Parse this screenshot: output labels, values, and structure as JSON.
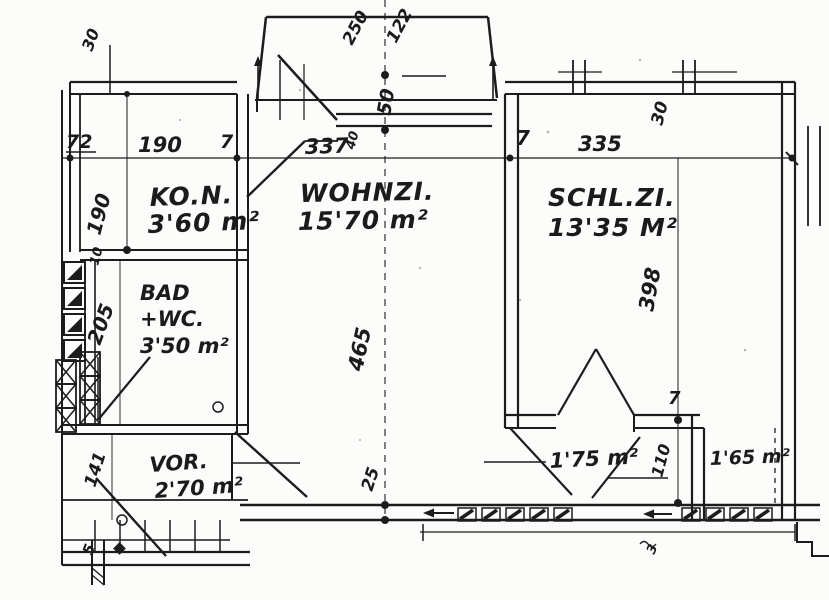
{
  "document": {
    "type": "architectural floor plan",
    "medium": "scanned hand-drawn blueprint",
    "ink_color": "#1c1c1c",
    "paper_color": "#fcfcfa"
  },
  "rooms": {
    "kitchen": {
      "label": "KO.N.",
      "area": "3'60 m²"
    },
    "living": {
      "label": "WOHNZI.",
      "area": "15'70 m²"
    },
    "bedroom": {
      "label": "SCHL.ZI.",
      "area": "13'35 M²"
    },
    "bath": {
      "label_line1": "BAD",
      "label_line2": "+WC.",
      "area": "3'50 m²"
    },
    "hall": {
      "label": "VOR.",
      "area": "2'70 m²"
    },
    "loggia_left": {
      "area": "1'75 m²"
    },
    "loggia_right": {
      "area": "1'65 m²"
    }
  },
  "dimensions": {
    "top_tick": "30",
    "left_wall": "72",
    "kitchen_width": "190",
    "partition_a": "7",
    "living_width": "337",
    "partition_b": "7",
    "bedroom_width": "335",
    "kitchen_depth": "190",
    "wall_10": "10",
    "bath_depth": "205",
    "hall_depth": "141",
    "living_depth": "465",
    "bedroom_depth": "398",
    "bay_a": "250",
    "bay_b": "122",
    "bay_depth": "50",
    "window_sill": "40",
    "bedroom_tick": "30",
    "sill_25": "25",
    "partition_c": "7",
    "loggia_depth": "110",
    "stair_tick": "5",
    "bottom_tick": "3"
  }
}
